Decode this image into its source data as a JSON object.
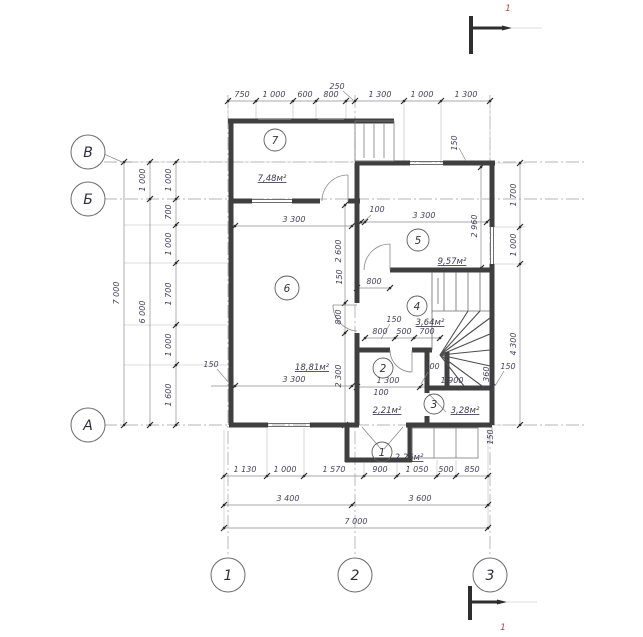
{
  "axes": {
    "left": [
      "В",
      "Б",
      "А"
    ],
    "bottom": [
      "1",
      "2",
      "3"
    ]
  },
  "section": {
    "top_label": "1",
    "bottom_label": "1"
  },
  "rooms": [
    {
      "number": "1",
      "area": "2,26м²"
    },
    {
      "number": "2",
      "area": "2,21м²"
    },
    {
      "number": "3",
      "area": "3,28м²"
    },
    {
      "number": "4",
      "area": "3,64м²"
    },
    {
      "number": "5",
      "area": "9,57м²"
    },
    {
      "number": "6",
      "area": "18,81м²"
    },
    {
      "number": "7",
      "area": "7,48м²"
    }
  ],
  "dims": {
    "top": [
      "750",
      "1 000",
      "600",
      "800",
      "1 300",
      "1 000",
      "1 300"
    ],
    "top_callout": "250",
    "left_inner": [
      "1 000",
      "700",
      "1 000",
      "1 700",
      "1 000",
      "1 600"
    ],
    "left_mid": [
      "1 000",
      "6 000"
    ],
    "left_outer": "7 000",
    "right": [
      "1 700",
      "1 000",
      "4 300"
    ],
    "bottom1": [
      "1 130",
      "1 000",
      "1 570",
      "900",
      "1 050",
      "500",
      "850"
    ],
    "bottom2": [
      "3 400",
      "3 600"
    ],
    "bottom3": "7 000",
    "interior": [
      "3 300",
      "100",
      "3 300",
      "2 960",
      "2 600",
      "150",
      "800",
      "800",
      "2 300",
      "150",
      "800",
      "500",
      "700",
      "100",
      "1 300",
      "100",
      "1 900",
      "1 360",
      "3 300",
      "150",
      "150",
      "150",
      "150"
    ]
  }
}
